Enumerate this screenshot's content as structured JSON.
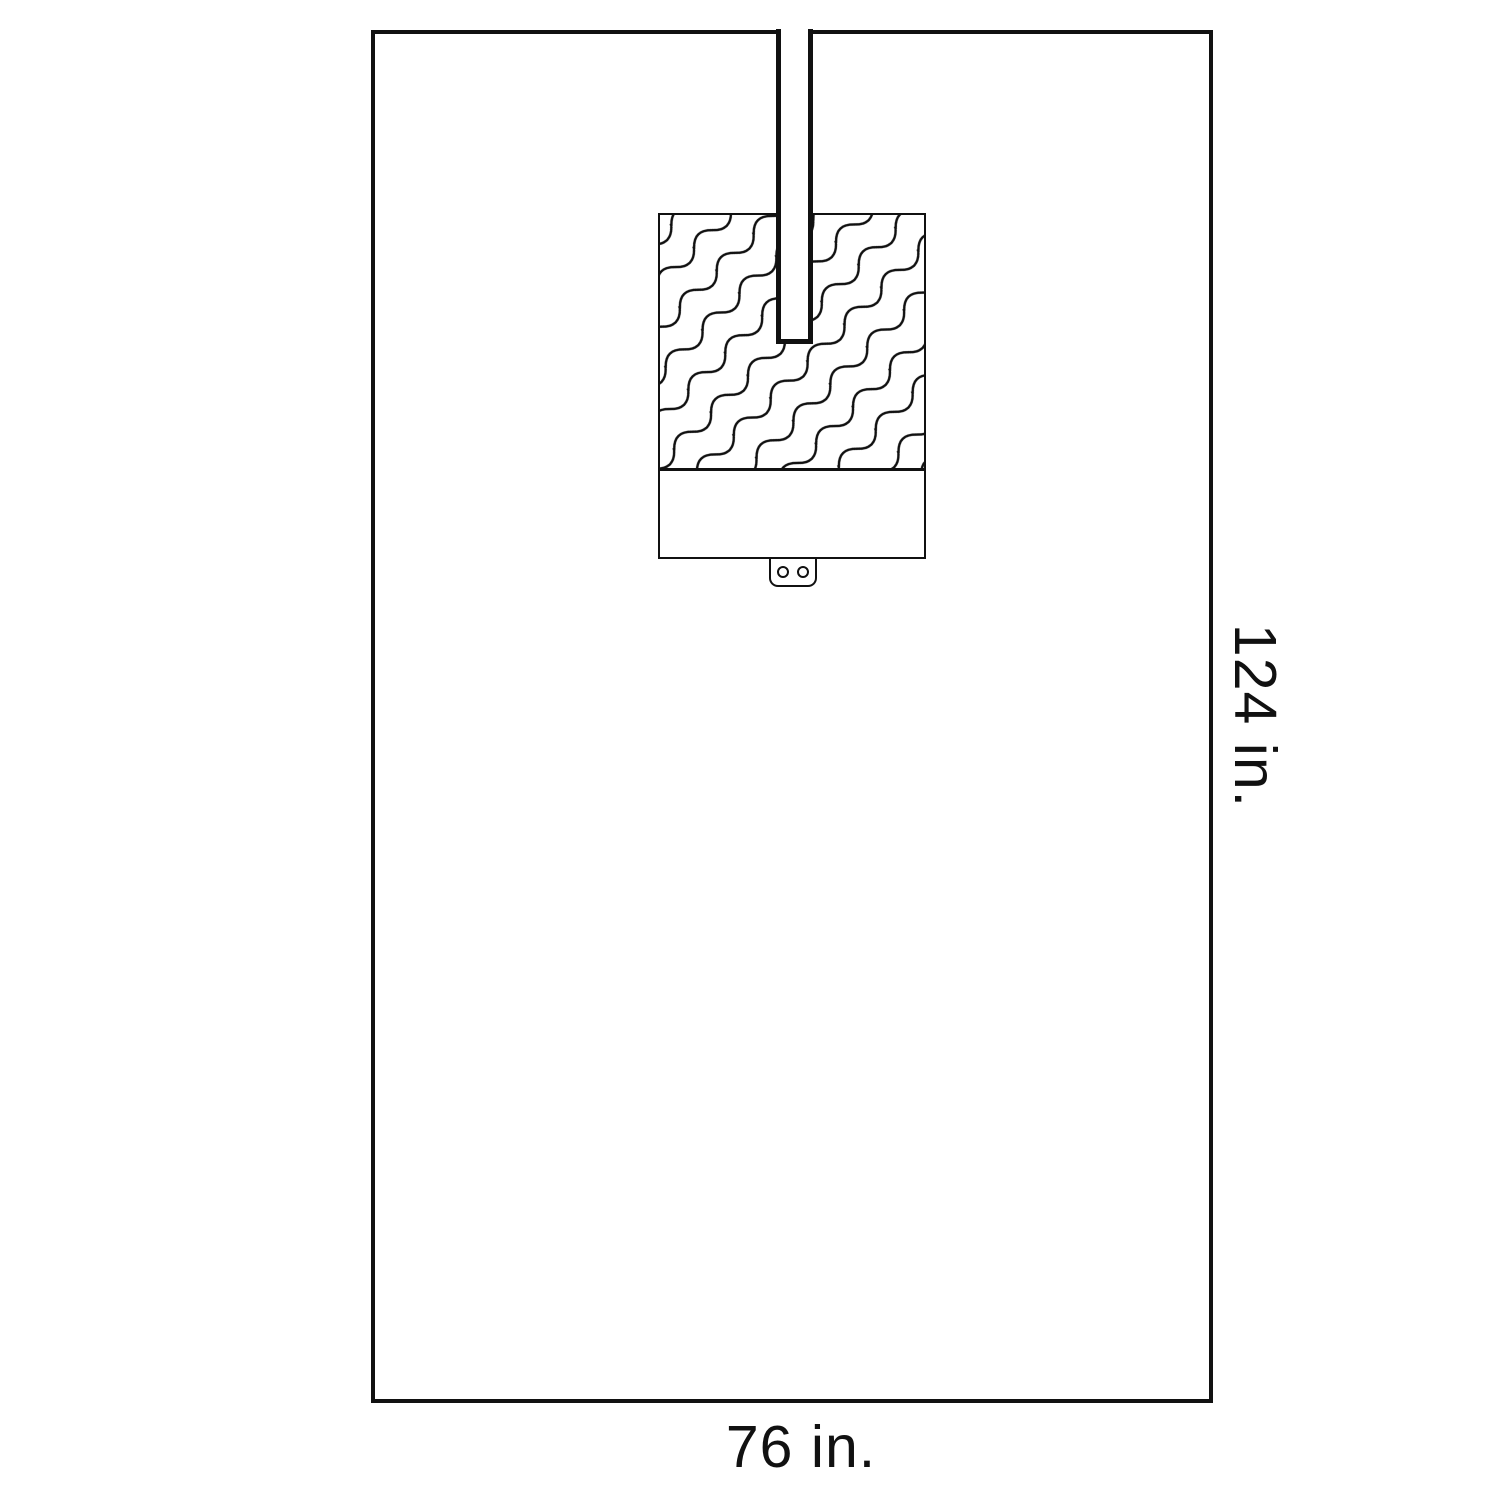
{
  "diagram": {
    "title": "surgical drape with slit, reinforcement patch and tube holder",
    "width_label": "76 in.",
    "height_label": "124 in.",
    "line_color": "#111111",
    "background_color": "#ffffff",
    "tab_hole_count": 2
  }
}
